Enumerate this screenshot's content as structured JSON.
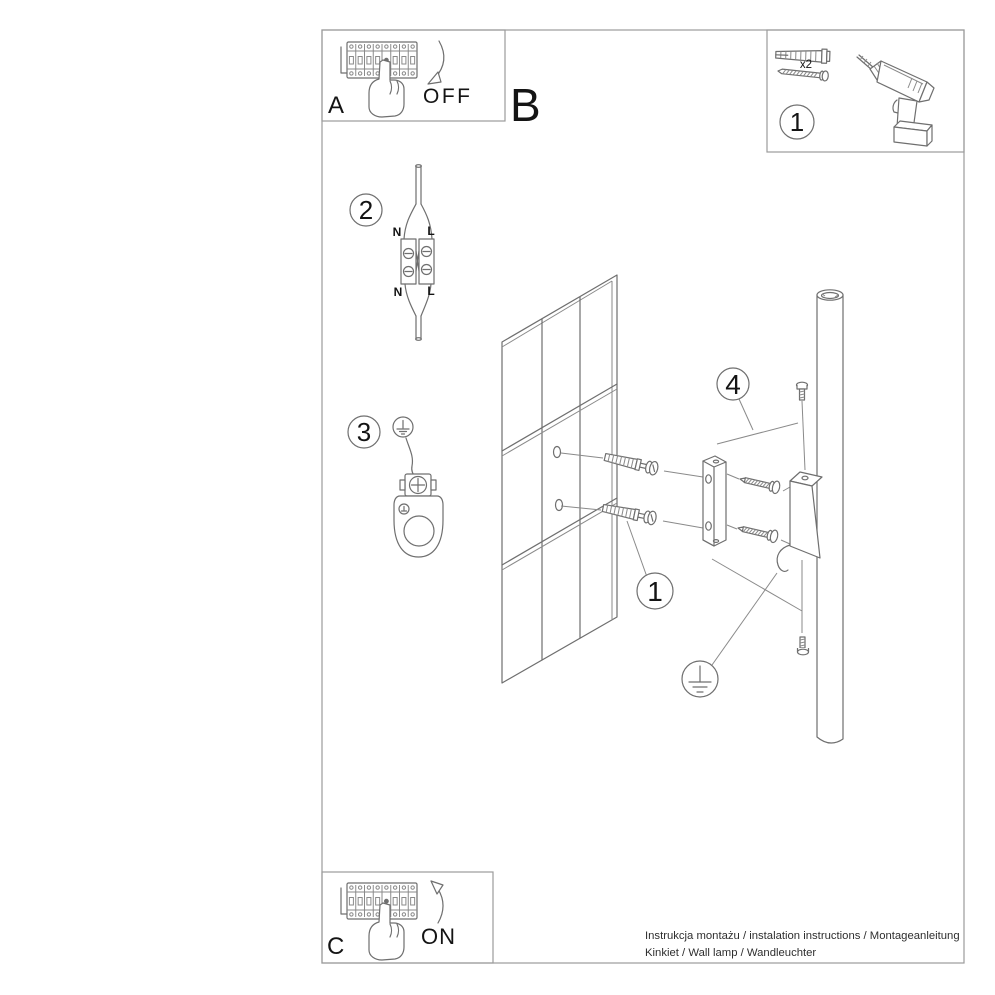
{
  "sections": {
    "power_off": {
      "label": "A",
      "action": "OFF"
    },
    "main": {
      "label": "B"
    },
    "power_on": {
      "label": "C",
      "action": "ON"
    },
    "tools": {
      "callout": "1",
      "screw_quantity": "x2"
    }
  },
  "callouts": {
    "anchors": "1",
    "wiring": "2",
    "grounding": "3",
    "set_screws": "4"
  },
  "wiring_labels": {
    "top_left": "N",
    "top_right": "L",
    "bottom_left": "N",
    "bottom_right": "L"
  },
  "footer": {
    "line1": "Instrukcja montażu / instalation instructions / Montageanleitung",
    "line2": "Kinkiet / Wall lamp / Wandleuchter"
  },
  "colors": {
    "background": "#ffffff",
    "line_art": "#6f6f6f",
    "frame": "#9b9b9b",
    "text": "#141414"
  }
}
